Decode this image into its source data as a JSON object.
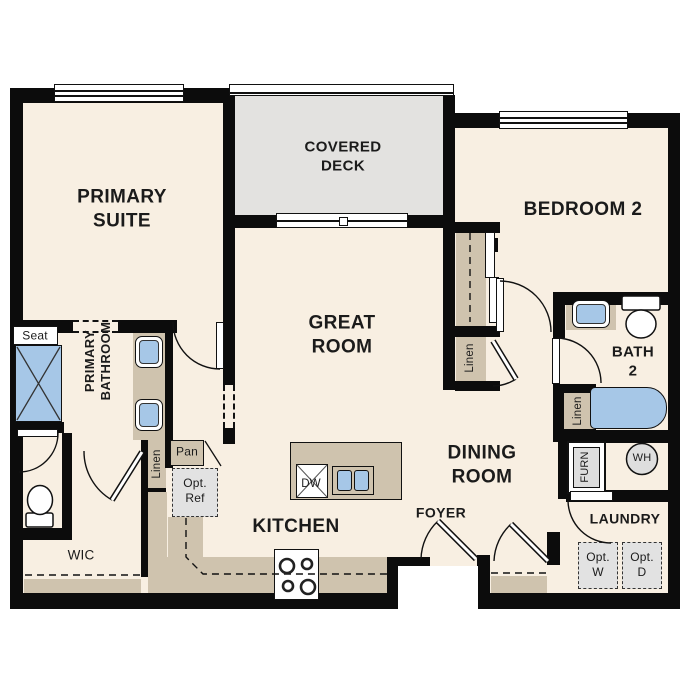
{
  "plan_title": "apartment-floor-plan",
  "rooms": {
    "primary_suite": "PRIMARY\nSUITE",
    "covered_deck": "COVERED\nDECK",
    "bedroom2": "BEDROOM 2",
    "great_room": "GREAT\nROOM",
    "primary_bathroom": "PRIMARY\nBATHROOM",
    "bath2": "BATH\n2",
    "dining_room": "DINING\nROOM",
    "kitchen": "KITCHEN",
    "foyer": "FOYER",
    "laundry": "LAUNDRY",
    "wic": "WIC"
  },
  "features": {
    "seat": "Seat",
    "linen_hall": "Linen",
    "linen_coat": "Linen",
    "linen_bath2": "Linen",
    "pantry": "Pan",
    "opt_ref": "Opt.\nRef",
    "dishwasher": "DW",
    "furnace": "FURN",
    "water_heater": "WH",
    "opt_washer": "Opt.\nW",
    "opt_dryer": "Opt.\nD"
  },
  "colors": {
    "floor": "#f8efe2",
    "deck": "#e3e2e0",
    "wall": "#0c0c0c",
    "cabinet_tan": "#cfc3ae",
    "fixture_blue": "#a6c7e7",
    "appliance_gray": "#e2e2e2"
  }
}
